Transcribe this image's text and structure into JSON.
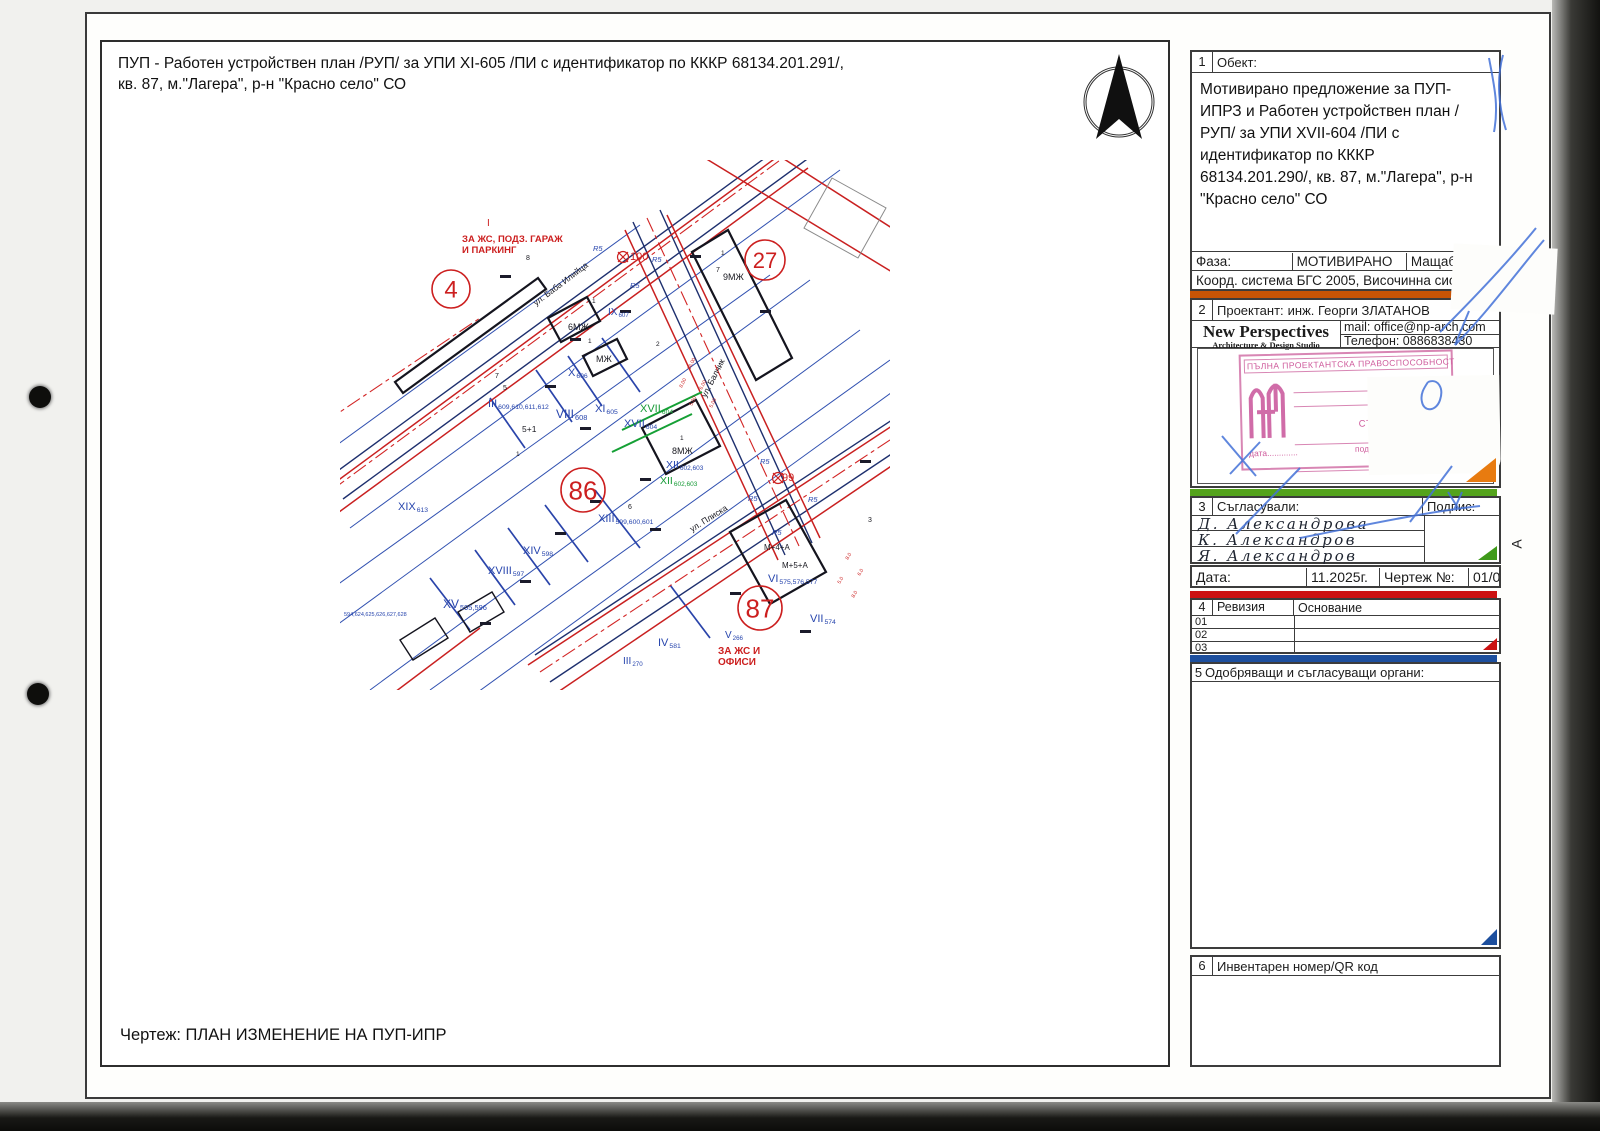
{
  "page": {
    "sheet_title": "ПУП - Работен устройствен план /РУП/ за УПИ XI-605 /ПИ с идентификатор по КККР 68134.201.291/,\nкв. 87, м.\"Лагера\", р-н \"Красно село\" СО",
    "drawing_caption": "Чертеж: ПЛАН ИЗМЕНЕНИЕ НА ПУП-ИПР",
    "edge_marker": "A"
  },
  "titleblock": {
    "object": {
      "num": "1",
      "label": "Обект:",
      "text": "Мотивирано предложение за ПУП-ИПРЗ и Работен устройствен план /РУП/ за УПИ XVII-604 /ПИ с идентификатор по КККР 68134.201.290/, кв. 87, м.\"Лагера\", р-н \"Красно село\" СО"
    },
    "phase": {
      "label": "Фаза:",
      "value": "МОТИВИРАНО",
      "scale_label": "Мащаб:",
      "scale_value": "1000"
    },
    "coord_row": "Коорд. система БГС 2005, Височинна система Ба",
    "designer": {
      "num": "2",
      "label": "Проектант:",
      "name": "инж. Георги ЗЛАТАНОВ",
      "studio_name": "New Perspectives",
      "studio_sub": "Architecture & Design Studio",
      "mail": "mail: office@np-arch.com",
      "phone": "Телефон: 0886838430"
    },
    "stamp": {
      "top": "ПЪЛНА ПРОЕКТАНТСКА ПРАВОСПОСОБНОСТ",
      "name1": "арх. НИКОЛ",
      "name2": "СТОЯНОВ ПЕТК",
      "reg": "Рег. №  05",
      "date_line": "дата.............",
      "sign_line": "подпис.........."
    },
    "approvals": {
      "num": "3",
      "label": "Съгласували:",
      "sign_label": "Подпис:",
      "names": [
        "Д. Александрова",
        "К. Александров",
        "Я. Александров"
      ]
    },
    "date_row": {
      "date_label": "Дата:",
      "date_value": "11.2025г.",
      "drawing_label": "Чертеж №:",
      "drawing_value": "01/02"
    },
    "revision": {
      "num": "4",
      "label": "Ревизия",
      "basis_label": "Основание",
      "rows": [
        "01",
        "02",
        "03"
      ]
    },
    "authorities": {
      "num": "5",
      "label": "Одобряващи и съгласуващи органи:"
    },
    "inventory": {
      "num": "6",
      "label": "Инвентарен номер/QR код"
    }
  },
  "colors": {
    "map_blue": "#2745ad",
    "map_red": "#cc1f1f",
    "map_green": "#169a36",
    "map_black": "#17171f",
    "bar_orange": "#c75406",
    "bar_green": "#54a31c",
    "bar_red": "#cc1212",
    "bar_blue": "#1d4f9e",
    "pen_blue": "#4472d8",
    "stamp_pink": "#cf5d9d"
  },
  "map": {
    "circles": [
      {
        "t": "4",
        "x": 111,
        "y": 129,
        "r": 19,
        "fs": 24
      },
      {
        "t": "27",
        "x": 425,
        "y": 100,
        "r": 20,
        "fs": 22
      },
      {
        "t": "86",
        "x": 243,
        "y": 330,
        "r": 22,
        "fs": 26
      },
      {
        "t": "87",
        "x": 420,
        "y": 448,
        "r": 22,
        "fs": 26
      }
    ],
    "labels": [
      {
        "t": "I",
        "x": 147,
        "y": 66,
        "c": "r",
        "s": 10
      },
      {
        "t": "ЗА ЖС, ПОДЗ. ГАРАЖ",
        "x": 122,
        "y": 82,
        "c": "r",
        "s": 9.5,
        "b": 1
      },
      {
        "t": "И ПАРКИНГ",
        "x": 122,
        "y": 93,
        "c": "r",
        "s": 9.5,
        "b": 1
      },
      {
        "t": "8",
        "x": 186,
        "y": 100,
        "c": "k",
        "s": 7
      },
      {
        "t": "1",
        "x": 381,
        "y": 95,
        "c": "k",
        "s": 6.5
      },
      {
        "t": "7",
        "x": 376,
        "y": 112,
        "c": "k",
        "s": 7
      },
      {
        "t": "9МЖ",
        "x": 383,
        "y": 120,
        "c": "k",
        "s": 9
      },
      {
        "t": "100",
        "x": 290,
        "y": 100,
        "c": "r",
        "s": 11
      },
      {
        "t": "R5",
        "x": 253,
        "y": 91,
        "c": "b",
        "s": 7.5,
        "i": 1
      },
      {
        "t": "R5",
        "x": 312,
        "y": 102,
        "c": "b",
        "s": 7.5,
        "i": 1
      },
      {
        "t": "R5",
        "x": 290,
        "y": 128,
        "c": "b",
        "s": 7.5,
        "i": 1
      },
      {
        "t": "R5",
        "x": 420,
        "y": 304,
        "c": "b",
        "s": 7.5,
        "i": 1
      },
      {
        "t": "R5",
        "x": 408,
        "y": 341,
        "c": "b",
        "s": 7.5,
        "i": 1
      },
      {
        "t": "R5",
        "x": 468,
        "y": 342,
        "c": "b",
        "s": 7.5,
        "i": 1
      },
      {
        "t": "R5",
        "x": 432,
        "y": 375,
        "c": "b",
        "s": 7.5,
        "i": 1
      },
      {
        "t": "ул. Баба Илийца",
        "x": 196,
        "y": 146,
        "c": "k",
        "s": 8.5,
        "a": -37
      },
      {
        "t": "IX",
        "x": 268,
        "y": 155,
        "c": "b",
        "s": 10,
        "sub": "607"
      },
      {
        "t": "6МЖ",
        "x": 228,
        "y": 170,
        "c": "k",
        "s": 9
      },
      {
        "t": "1",
        "x": 252,
        "y": 143,
        "c": "k",
        "s": 6.5
      },
      {
        "t": "МЖ",
        "x": 256,
        "y": 202,
        "c": "k",
        "s": 9
      },
      {
        "t": "1",
        "x": 248,
        "y": 183,
        "c": "k",
        "s": 6.5
      },
      {
        "t": "2",
        "x": 316,
        "y": 186,
        "c": "k",
        "s": 6.5
      },
      {
        "t": "X",
        "x": 228,
        "y": 216,
        "c": "b",
        "s": 11,
        "sub": "606"
      },
      {
        "t": "III",
        "x": 148,
        "y": 247,
        "c": "b",
        "s": 11,
        "sub": "609,610,611,612"
      },
      {
        "t": "7",
        "x": 155,
        "y": 218,
        "c": "k",
        "s": 7
      },
      {
        "t": "5",
        "x": 163,
        "y": 230,
        "c": "k",
        "s": 7
      },
      {
        "t": "5+1",
        "x": 182,
        "y": 272,
        "c": "k",
        "s": 8.5
      },
      {
        "t": "1",
        "x": 176,
        "y": 296,
        "c": "k",
        "s": 6.5
      },
      {
        "t": "VIII",
        "x": 216,
        "y": 258,
        "c": "b",
        "s": 12,
        "sub": "608"
      },
      {
        "t": "XI",
        "x": 255,
        "y": 252,
        "c": "b",
        "s": 11,
        "sub": "605"
      },
      {
        "t": "XVII",
        "x": 300,
        "y": 252,
        "c": "g",
        "s": 11,
        "sub": "604"
      },
      {
        "t": "XVII",
        "x": 284,
        "y": 267,
        "c": "b",
        "s": 11,
        "sub": "604"
      },
      {
        "t": "1",
        "x": 340,
        "y": 280,
        "c": "k",
        "s": 6.5
      },
      {
        "t": "8МЖ",
        "x": 332,
        "y": 294,
        "c": "k",
        "s": 9
      },
      {
        "t": "XII",
        "x": 326,
        "y": 308,
        "c": "b",
        "s": 10.5,
        "sub": "602,603"
      },
      {
        "t": "XII",
        "x": 320,
        "y": 324,
        "c": "g",
        "s": 10.5,
        "sub": "602,603"
      },
      {
        "t": "ул. Балчик",
        "x": 366,
        "y": 238,
        "c": "k",
        "s": 8.5,
        "a": -63
      },
      {
        "t": "99",
        "x": 442,
        "y": 321,
        "c": "r",
        "s": 11
      },
      {
        "t": "ул. Плиска",
        "x": 352,
        "y": 372,
        "c": "k",
        "s": 8.5,
        "a": -32
      },
      {
        "t": "XIX",
        "x": 58,
        "y": 350,
        "c": "b",
        "s": 11,
        "sub": "613"
      },
      {
        "t": "6",
        "x": 288,
        "y": 349,
        "c": "k",
        "s": 7
      },
      {
        "t": "XIII",
        "x": 258,
        "y": 362,
        "c": "b",
        "s": 11,
        "sub": "599,600,601"
      },
      {
        "t": "XIV",
        "x": 183,
        "y": 394,
        "c": "b",
        "s": 11,
        "sub": "598"
      },
      {
        "t": "XVIII",
        "x": 148,
        "y": 414,
        "c": "b",
        "s": 11,
        "sub": "597"
      },
      {
        "t": "XV",
        "x": 103,
        "y": 448,
        "c": "b",
        "s": 12,
        "sub": "595,596"
      },
      {
        "t": "594,624,625,626,627,628",
        "x": 4,
        "y": 456,
        "c": "b",
        "s": 5.5
      },
      {
        "t": "M+4+A",
        "x": 424,
        "y": 390,
        "c": "k",
        "s": 8
      },
      {
        "t": "M+5+A",
        "x": 442,
        "y": 408,
        "c": "k",
        "s": 8
      },
      {
        "t": "VI",
        "x": 428,
        "y": 422,
        "c": "b",
        "s": 11,
        "sub": "575,576,577"
      },
      {
        "t": "VII",
        "x": 470,
        "y": 462,
        "c": "b",
        "s": 11,
        "sub": "574"
      },
      {
        "t": "IV",
        "x": 318,
        "y": 486,
        "c": "b",
        "s": 11,
        "sub": "581"
      },
      {
        "t": "V",
        "x": 385,
        "y": 478,
        "c": "b",
        "s": 10,
        "sub": "266"
      },
      {
        "t": "ЗА ЖС И",
        "x": 378,
        "y": 494,
        "c": "r",
        "s": 10,
        "b": 1
      },
      {
        "t": "ОФИСИ",
        "x": 378,
        "y": 505,
        "c": "r",
        "s": 10,
        "b": 1
      },
      {
        "t": "III",
        "x": 283,
        "y": 504,
        "c": "b",
        "s": 10,
        "sub": "270"
      },
      {
        "t": "3",
        "x": 528,
        "y": 362,
        "c": "k",
        "s": 7
      },
      {
        "t": "16.00",
        "x": 350,
        "y": 210,
        "c": "r",
        "s": 5,
        "a": -63
      },
      {
        "t": "8.00",
        "x": 342,
        "y": 228,
        "c": "r",
        "s": 5,
        "a": -63
      },
      {
        "t": "5.00",
        "x": 352,
        "y": 246,
        "c": "r",
        "s": 5,
        "a": -63
      },
      {
        "t": "6.00",
        "x": 362,
        "y": 230,
        "c": "r",
        "s": 5,
        "a": -63
      },
      {
        "t": "5.00",
        "x": 372,
        "y": 248,
        "c": "r",
        "s": 5,
        "a": -63
      },
      {
        "t": "8.0",
        "x": 508,
        "y": 400,
        "c": "r",
        "s": 5,
        "a": -60
      },
      {
        "t": "6.0",
        "x": 520,
        "y": 416,
        "c": "r",
        "s": 5,
        "a": -60
      },
      {
        "t": "5.0",
        "x": 500,
        "y": 424,
        "c": "r",
        "s": 5,
        "a": -60
      },
      {
        "t": "8.0",
        "x": 514,
        "y": 438,
        "c": "r",
        "s": 5,
        "a": -60
      }
    ]
  }
}
